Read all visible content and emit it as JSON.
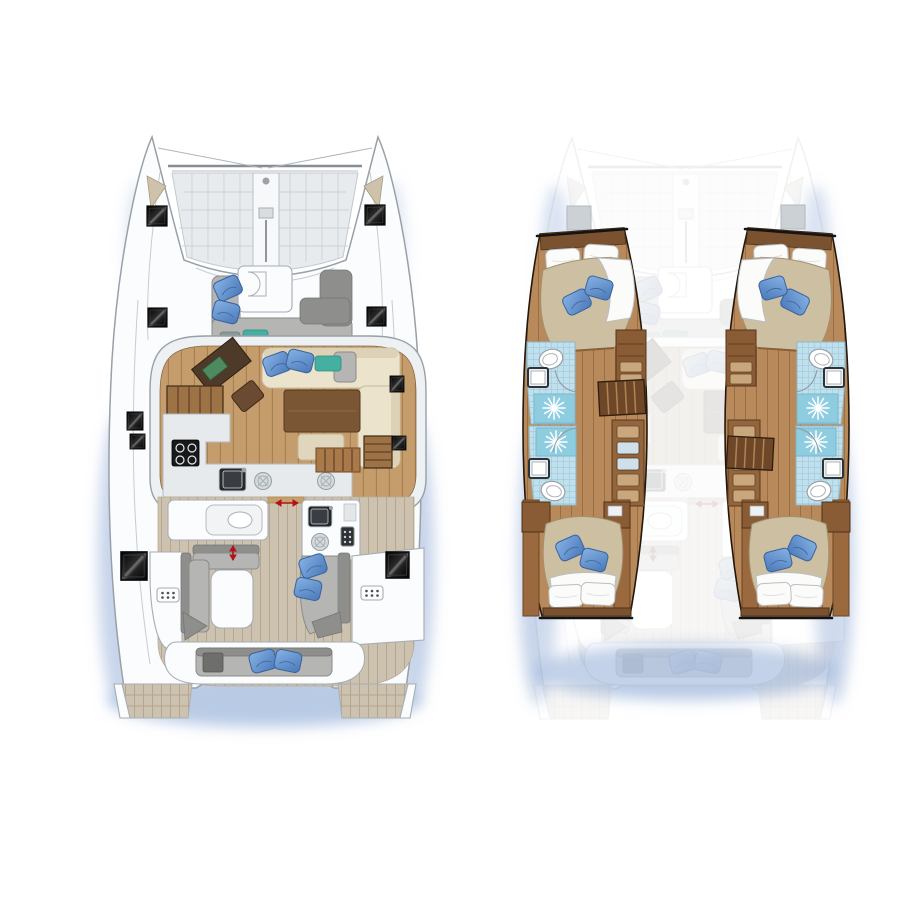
{
  "page": {
    "title": "catamaran-layout-floorplan",
    "background": "#ffffff"
  },
  "colors": {
    "hull-white": "#fbfcfd",
    "outline": "#98a0a8",
    "detail-line": "#c7ccd2",
    "cut-line": "#141414",
    "trampoline": "#e8ebee",
    "trampoline-line": "#ccd1d7",
    "hatch-black": "#101010",
    "anchor-locker": "#cec2aa",
    "teak": "#cdc2b0",
    "teak-line": "#b4a78f",
    "wood-saloon": "#c59c6c",
    "wood-saloon-line": "#a87e4e",
    "wood-cabin": "#b8895a",
    "wood-cabin-line": "#9a6e41",
    "wood-dark": "#4e3a28",
    "wood-mid": "#8a5c36",
    "wood-step": "#6e4728",
    "counter": "#e7eaec",
    "appliance-black": "#17191b",
    "sofa-cream": "#ece3cc",
    "cushion-gray": "#b5b5b3",
    "cushion-gray-dark": "#8e8e8c",
    "pillow-blue": "#6b9bd8",
    "pillow-blue-dark": "#3a66a0",
    "cushion-teal": "#45b0a2",
    "duvet": "#cdbfa2",
    "linen-white": "#fbfbfa",
    "tile": "#bfe0ec",
    "tile-line": "#9fcadb",
    "shower": "#8ecde0",
    "drawer-blue": "#cfe0ea",
    "drawer-tan": "#c9a77c",
    "arrow-red": "#b3121a",
    "shadow": "#a7bddf"
  },
  "views": {
    "deck_plan": {
      "name": "deck-and-saloon-plan",
      "areas": [
        "bow-trampoline",
        "foredeck-lounge",
        "saloon-dinette",
        "navigation-station",
        "galley",
        "cockpit-lounge",
        "wet-bar",
        "aft-bench",
        "transom-steps"
      ]
    },
    "accommodation_plan": {
      "name": "hull-accommodation-plan",
      "areas": [
        "port-forward-cabin",
        "port-forward-bathroom",
        "port-shower",
        "port-companionway",
        "port-aft-cabin",
        "starboard-forward-cabin",
        "starboard-forward-bathroom",
        "starboard-shower",
        "starboard-companionway",
        "starboard-aft-cabin"
      ]
    }
  }
}
